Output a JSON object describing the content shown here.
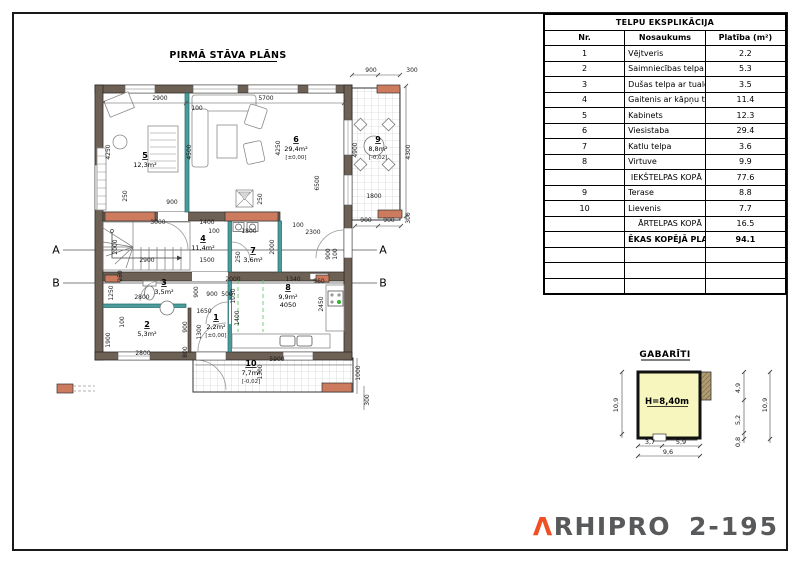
{
  "colors": {
    "wall": "#6d6156",
    "accent_orange": "#cc7b5e",
    "teal_wall": "#2f8486",
    "gab_yellow": "#f6f6be",
    "gab_tan": "#b09c72",
    "frame": "#1a1a1a",
    "logo_orange": "#f04e23",
    "logo_gray": "#58595b",
    "stove_green": "#2db52d"
  },
  "plan": {
    "title": "PIRMĀ STĀVA PLĀNS",
    "section_markers": [
      {
        "label": "A",
        "y": 250
      },
      {
        "label": "B",
        "y": 283
      }
    ],
    "rooms": [
      {
        "num": "1",
        "area": "2,2m²",
        "level": "[±0,00]",
        "x": 216,
        "y": 320
      },
      {
        "num": "2",
        "area": "5,3m²",
        "x": 147,
        "y": 327
      },
      {
        "num": "3",
        "area": "3,5m²",
        "x": 164,
        "y": 285
      },
      {
        "num": "4",
        "area": "11,4m²",
        "x": 203,
        "y": 241
      },
      {
        "num": "5",
        "area": "12,3m²",
        "x": 145,
        "y": 158
      },
      {
        "num": "6",
        "area": "29,4m²",
        "level": "[±0,00]",
        "x": 296,
        "y": 142
      },
      {
        "num": "7",
        "area": "3,6m²",
        "x": 253,
        "y": 253
      },
      {
        "num": "8",
        "area": "9,9m²",
        "extra": "4050",
        "x": 288,
        "y": 290
      },
      {
        "num": "9",
        "area": "8,8m²",
        "level": "[-0,02]",
        "x": 378,
        "y": 142
      },
      {
        "num": "10",
        "area": "7,7m²",
        "level": "[-0,02]",
        "x": 251,
        "y": 366
      }
    ],
    "dimensions": [
      {
        "t": "2900",
        "x": 160,
        "y": 100
      },
      {
        "t": "100",
        "x": 197,
        "y": 110
      },
      {
        "t": "5700",
        "x": 266,
        "y": 100
      },
      {
        "t": "900",
        "x": 371,
        "y": 72
      },
      {
        "t": "300",
        "x": 412,
        "y": 72
      },
      {
        "t": "4250",
        "x": 110,
        "y": 152,
        "r": -90
      },
      {
        "t": "250",
        "x": 127,
        "y": 196,
        "r": -90
      },
      {
        "t": "900",
        "x": 172,
        "y": 204
      },
      {
        "t": "4500",
        "x": 191,
        "y": 152,
        "r": -90
      },
      {
        "t": "4250",
        "x": 280,
        "y": 148,
        "r": -90
      },
      {
        "t": "6500",
        "x": 319,
        "y": 183,
        "r": -90
      },
      {
        "t": "250",
        "x": 262,
        "y": 199,
        "r": -90
      },
      {
        "t": "4900",
        "x": 357,
        "y": 150,
        "r": -90
      },
      {
        "t": "4300",
        "x": 410,
        "y": 152,
        "r": -90
      },
      {
        "t": "1800",
        "x": 374,
        "y": 198
      },
      {
        "t": "900",
        "x": 366,
        "y": 222
      },
      {
        "t": "900",
        "x": 389,
        "y": 222
      },
      {
        "t": "300",
        "x": 410,
        "y": 218,
        "r": -90
      },
      {
        "t": "3000",
        "x": 158,
        "y": 224
      },
      {
        "t": "1400",
        "x": 207,
        "y": 224
      },
      {
        "t": "100",
        "x": 214,
        "y": 233
      },
      {
        "t": "1800",
        "x": 249,
        "y": 233
      },
      {
        "t": "100",
        "x": 298,
        "y": 227
      },
      {
        "t": "2300",
        "x": 313,
        "y": 234
      },
      {
        "t": "2000",
        "x": 117,
        "y": 247,
        "r": -90
      },
      {
        "t": "2900",
        "x": 147,
        "y": 262
      },
      {
        "t": "1500",
        "x": 207,
        "y": 262
      },
      {
        "t": "250",
        "x": 240,
        "y": 257,
        "r": -90
      },
      {
        "t": "2000",
        "x": 274,
        "y": 247,
        "r": -90
      },
      {
        "t": "900",
        "x": 330,
        "y": 254,
        "r": -90
      },
      {
        "t": "100",
        "x": 337,
        "y": 254,
        "r": -90
      },
      {
        "t": "250",
        "x": 122,
        "y": 276,
        "r": -90
      },
      {
        "t": "1250",
        "x": 113,
        "y": 293,
        "r": -90
      },
      {
        "t": "2800",
        "x": 142,
        "y": 299
      },
      {
        "t": "2000",
        "x": 233,
        "y": 281
      },
      {
        "t": "1340",
        "x": 293,
        "y": 281
      },
      {
        "t": "960",
        "x": 319,
        "y": 283
      },
      {
        "t": "900",
        "x": 198,
        "y": 292,
        "r": -90
      },
      {
        "t": "900",
        "x": 212,
        "y": 296
      },
      {
        "t": "500",
        "x": 227,
        "y": 296
      },
      {
        "t": "1050",
        "x": 235,
        "y": 296,
        "r": -90
      },
      {
        "t": "1650",
        "x": 204,
        "y": 313
      },
      {
        "t": "1400",
        "x": 239,
        "y": 318,
        "r": -90
      },
      {
        "t": "2450",
        "x": 323,
        "y": 304,
        "r": -90
      },
      {
        "t": "100",
        "x": 124,
        "y": 322,
        "r": -90
      },
      {
        "t": "1900",
        "x": 110,
        "y": 340,
        "r": -90
      },
      {
        "t": "900",
        "x": 187,
        "y": 327,
        "r": -90
      },
      {
        "t": "1300",
        "x": 201,
        "y": 332,
        "r": -90
      },
      {
        "t": "2800",
        "x": 143,
        "y": 355
      },
      {
        "t": "800",
        "x": 187,
        "y": 352,
        "r": -90
      },
      {
        "t": "5900",
        "x": 277,
        "y": 361
      },
      {
        "t": "1300",
        "x": 262,
        "y": 372,
        "r": -90
      },
      {
        "t": "1000",
        "x": 360,
        "y": 373,
        "r": -90
      },
      {
        "t": "300",
        "x": 369,
        "y": 400,
        "r": -90
      }
    ]
  },
  "table": {
    "title": "TELPU EKSPLIKĀCIJA",
    "columns": [
      "Nr.",
      "Nosaukums",
      "Platība (m²)"
    ],
    "rows": [
      {
        "nr": "1",
        "name": "Vējtveris",
        "area": "2.2"
      },
      {
        "nr": "2",
        "name": "Saimniecības telpa",
        "area": "5.3"
      },
      {
        "nr": "3",
        "name": "Dušas telpa ar tualeti",
        "area": "3.5"
      },
      {
        "nr": "4",
        "name": "Gaitenis ar kāpņu telpu",
        "area": "11.4"
      },
      {
        "nr": "5",
        "name": "Kabinets",
        "area": "12.3"
      },
      {
        "nr": "6",
        "name": "Viesistaba",
        "area": "29.4"
      },
      {
        "nr": "7",
        "name": "Katlu telpa",
        "area": "3.6"
      },
      {
        "nr": "8",
        "name": "Virtuve",
        "area": "9.9"
      },
      {
        "nr": "",
        "name": "IEKŠTELPAS KOPĀ",
        "area": "77.6",
        "style": "sub"
      },
      {
        "nr": "9",
        "name": "Terase",
        "area": "8.8"
      },
      {
        "nr": "10",
        "name": "Lievenis",
        "area": "7.7"
      },
      {
        "nr": "",
        "name": "ĀRTELPAS KOPĀ",
        "area": "16.5",
        "style": "sub"
      },
      {
        "nr": "",
        "name": "ĒKAS KOPĒJĀ PLATĪBA",
        "area": "94.1",
        "style": "total"
      },
      {
        "nr": "",
        "name": "",
        "area": ""
      },
      {
        "nr": "",
        "name": "",
        "area": ""
      },
      {
        "nr": "",
        "name": "",
        "area": ""
      }
    ]
  },
  "gabariti": {
    "title": "GABARĪTI",
    "height_label": "H=8,40m",
    "dims": [
      {
        "t": "10,9",
        "x": 618,
        "y": 405,
        "r": -90
      },
      {
        "t": "4,9",
        "x": 740,
        "y": 388,
        "r": -90
      },
      {
        "t": "5,2",
        "x": 740,
        "y": 420,
        "r": -90
      },
      {
        "t": "0,8",
        "x": 740,
        "y": 442,
        "r": -90
      },
      {
        "t": "10,9",
        "x": 767,
        "y": 405,
        "r": -90
      },
      {
        "t": "3,7",
        "x": 650,
        "y": 444
      },
      {
        "t": "5,9",
        "x": 681,
        "y": 444
      },
      {
        "t": "9,6",
        "x": 668,
        "y": 454
      }
    ]
  },
  "logo": {
    "mark": "Λ",
    "rest": "RHIPRO",
    "number": "2-195"
  }
}
